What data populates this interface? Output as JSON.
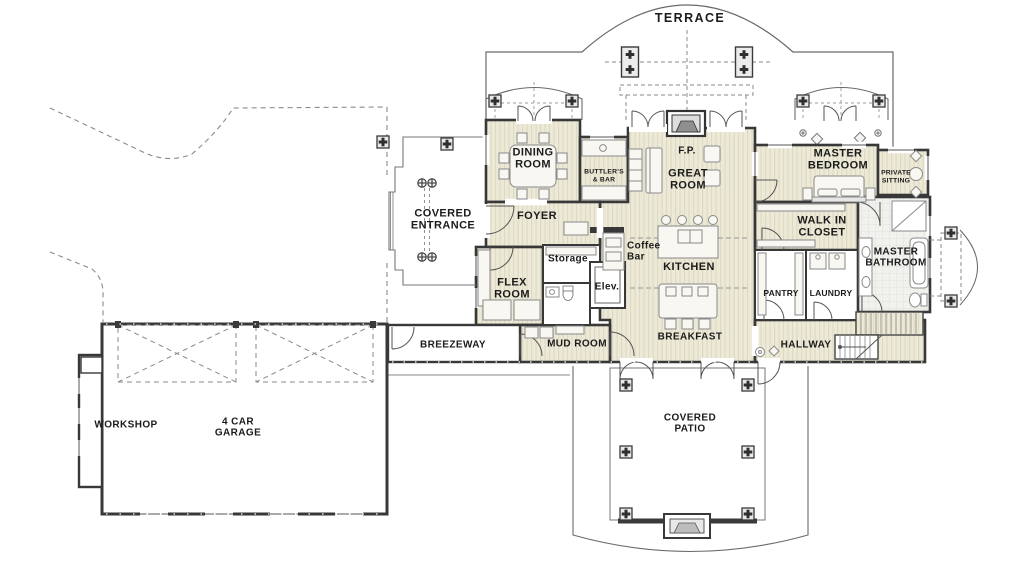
{
  "drawing": {
    "type": "architectural first-floor plan",
    "colors": {
      "room_fill": "#ECE9D7",
      "room_stripe": "#DDD9C2",
      "tile_fill": "#F1F1ED",
      "wall": "#383838",
      "thin_line": "#666666",
      "dashed_line": "#909090",
      "text": "#1b1b1b",
      "background": "#ffffff"
    }
  },
  "labels": {
    "terrace": "TERRACE",
    "dining_room": "DINING\nROOM",
    "butlers_bar": "BUTTLER'S\n& BAR",
    "fireplace": "F.P.",
    "great_room": "GREAT\nROOM",
    "master_bedroom": "MASTER\nBEDROOM",
    "private_sitting": "PRIVATE\nSITTING",
    "covered_entrance": "COVERED\nENTRANCE",
    "foyer": "FOYER",
    "walk_in_closet": "WALK IN\nCLOSET",
    "master_bathroom": "MASTER\nBATHROOM",
    "flex_room": "FLEX\nROOM",
    "storage": "Storage",
    "coffee_bar": "Coffee\nBar",
    "elevator": "Elev.",
    "kitchen": "KITCHEN",
    "pantry": "PANTRY",
    "laundry": "LAUNDRY",
    "breezeway": "BREEZEWAY",
    "mud_room": "MUD ROOM",
    "breakfast": "BREAKFAST",
    "hallway": "HALLWAY",
    "workshop": "WORKSHOP",
    "garage": "4 CAR\nGARAGE",
    "covered_patio": "COVERED\nPATIO"
  }
}
